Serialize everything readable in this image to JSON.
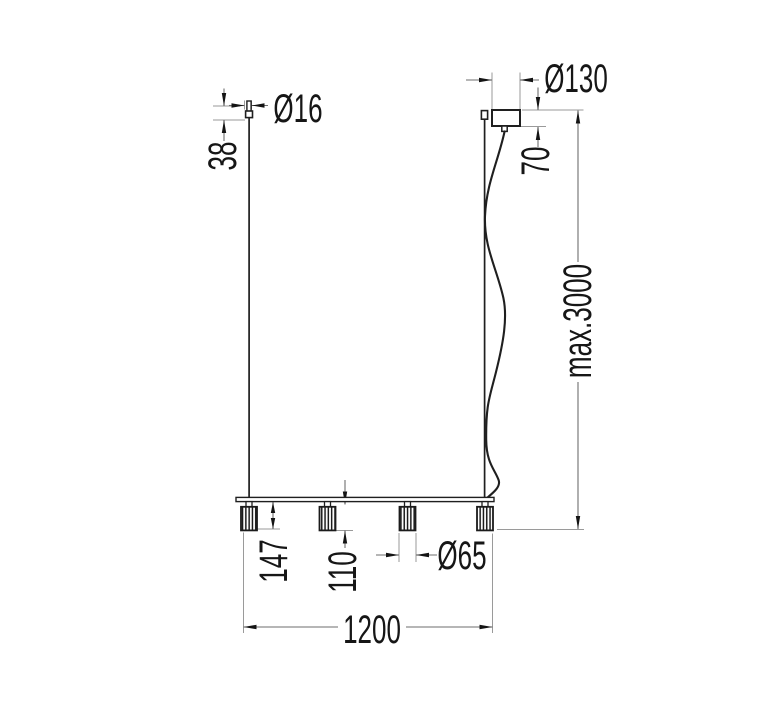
{
  "diagram": {
    "title": "linear-pendant-light-dimension-drawing",
    "description": "Technical line drawing of a 4-spot linear suspension lamp with dimension callouts",
    "dimensions": {
      "cap_diameter": "Ø16",
      "cap_height": "38",
      "canopy_diameter": "Ø130",
      "canopy_height": "70",
      "max_suspension": "max.3000",
      "spot_drop": "147",
      "spot_height": "110",
      "spot_diameter": "Ø65",
      "bar_length": "1200"
    },
    "colors": {
      "background": "#ffffff",
      "object_line": "#1f1f1f",
      "dimension_line": "#6e6e6e",
      "extension_line": "#9a9a9a",
      "text": "#161616"
    }
  }
}
